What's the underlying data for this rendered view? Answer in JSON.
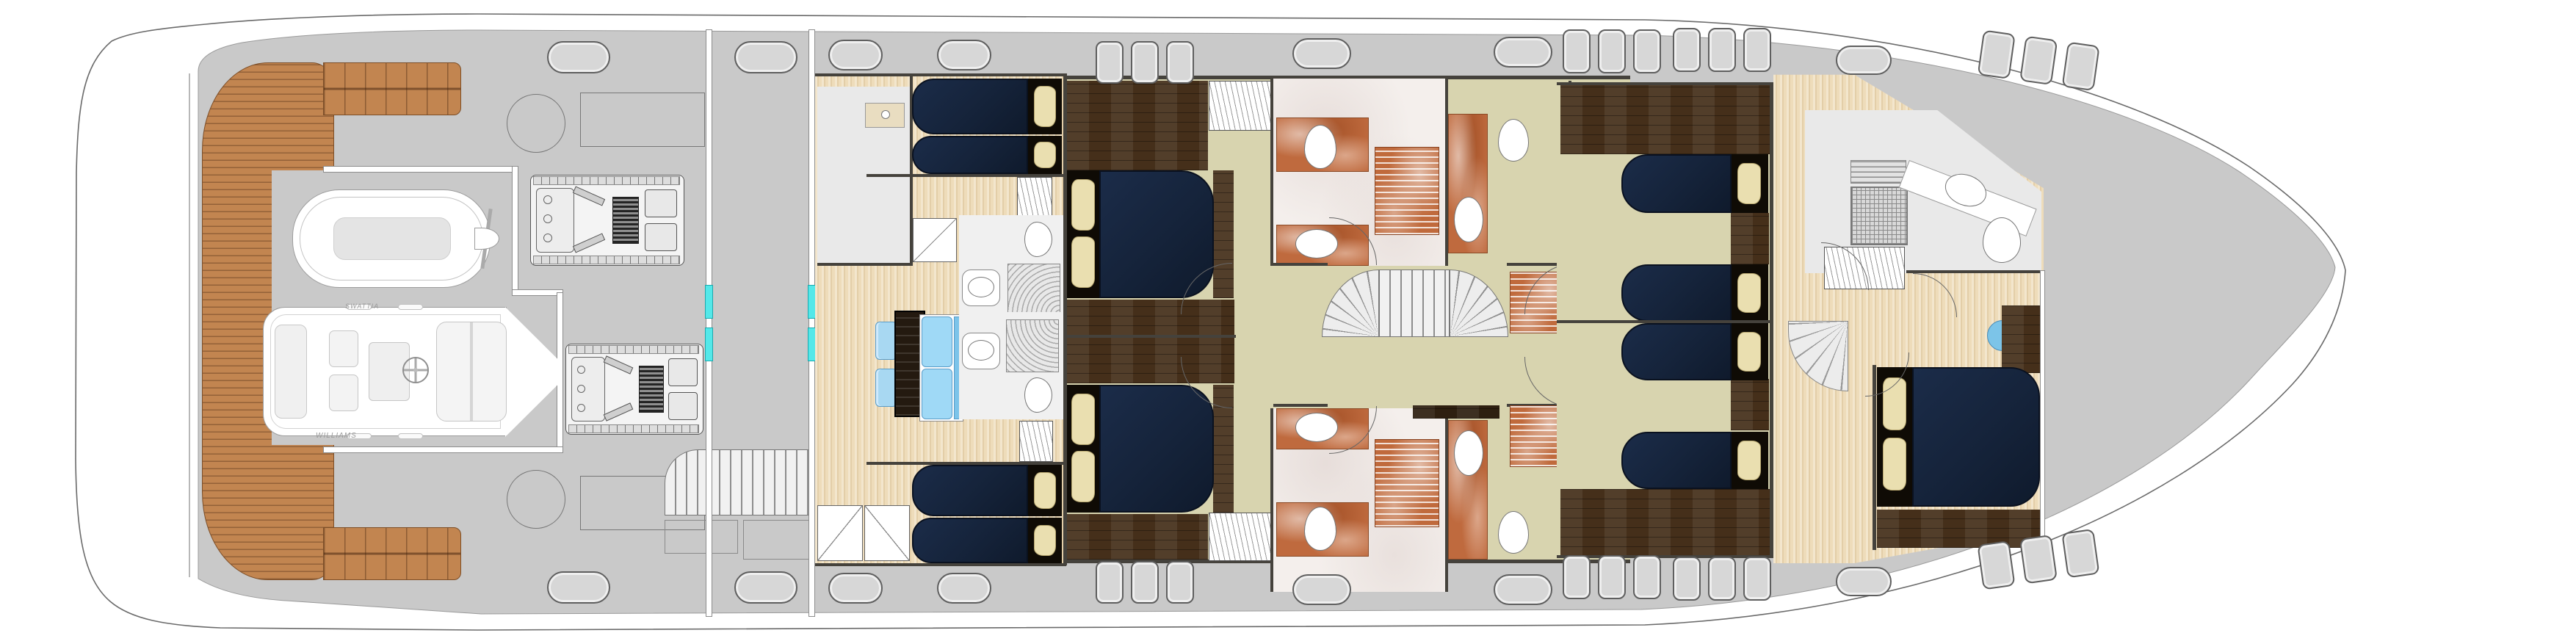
{
  "plan": {
    "type": "yacht-lower-deck-floorplan",
    "labels": {
      "tender": "WILLIAMS",
      "jetski_tag": "SWATTIA"
    },
    "palette": {
      "hull_white": "#ffffff",
      "deck_gray": "#c9c9c9",
      "teak": "#c28550",
      "maple_floor": "#eedcba",
      "khaki_floor": "#d8d4af",
      "dark_wood_floor": "#452f1a",
      "navy_bed": "#15233a",
      "pillow_beige": "#eadfb0",
      "orange_marble": "#bf6a3e",
      "white_marble": "#f4efec",
      "sofa_blue": "#9fd9f6",
      "watertight_door_cyan": "#54e8e9"
    },
    "features": {
      "engines": 2,
      "tenders": 2,
      "double_bed_cabins": 3,
      "twin_bed_cabins": 2,
      "crew_bunk_cabins": 2,
      "staircases": 3
    }
  }
}
